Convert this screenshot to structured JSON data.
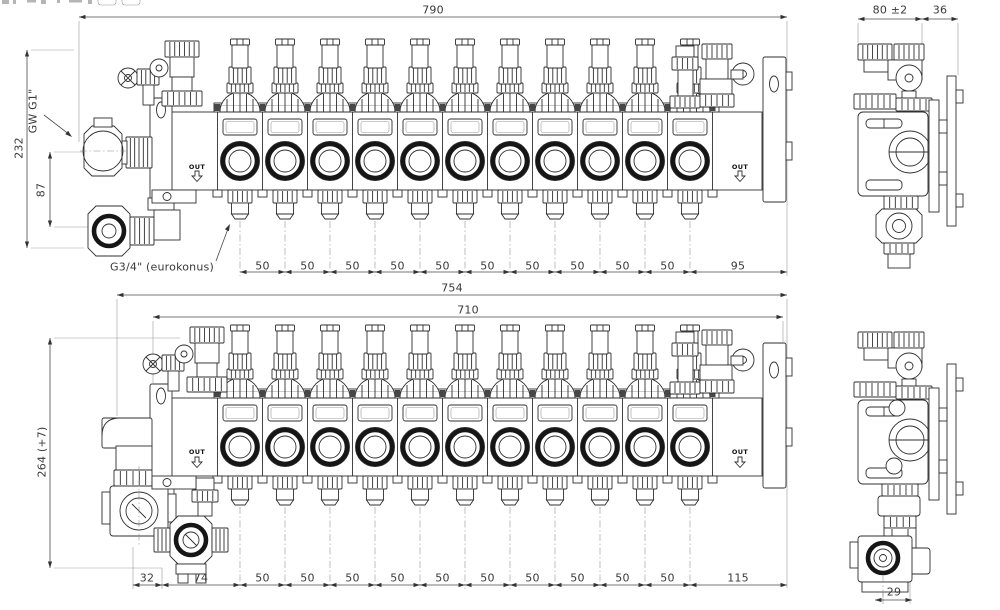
{
  "drawing_type": "technical-cad-manifold",
  "colors": {
    "background": "#ffffff",
    "linework": "#2f2f2f",
    "dimensions": "#4a4a4a"
  },
  "views": {
    "manifold_top": {
      "name": "11-circuit manifold - front view",
      "loop_count": 11,
      "out_label_left": "OUT",
      "out_label_right": "OUT",
      "dim_total_width": "790",
      "dim_height": "232",
      "dim_port_spacing": "87",
      "label_supply_thread": "GW G1\"",
      "label_outlet_thread": "G3/4\" (eurokonus)",
      "outlet_spacings": [
        "50",
        "50",
        "50",
        "50",
        "50",
        "50",
        "50",
        "50",
        "50",
        "50"
      ],
      "dim_end_section": "95",
      "side": {
        "name": "side view",
        "dim_depth": "80 ±2",
        "dim_bracket_offset": "36"
      }
    },
    "manifold_bottom": {
      "name": "11-circuit manifold with pump mixing unit - front view",
      "loop_count": 11,
      "out_label_left": "OUT",
      "out_label_right": "OUT",
      "dim_total_width": "754",
      "dim_rail_width": "710",
      "dim_height": "264 (+7)",
      "dim_left_offsets": [
        "32",
        "74"
      ],
      "outlet_spacings": [
        "50",
        "50",
        "50",
        "50",
        "50",
        "50",
        "50",
        "50",
        "50",
        "50"
      ],
      "dim_end_section": "115",
      "side": {
        "name": "side view with pump",
        "dim_pump_offset": "29"
      }
    }
  }
}
